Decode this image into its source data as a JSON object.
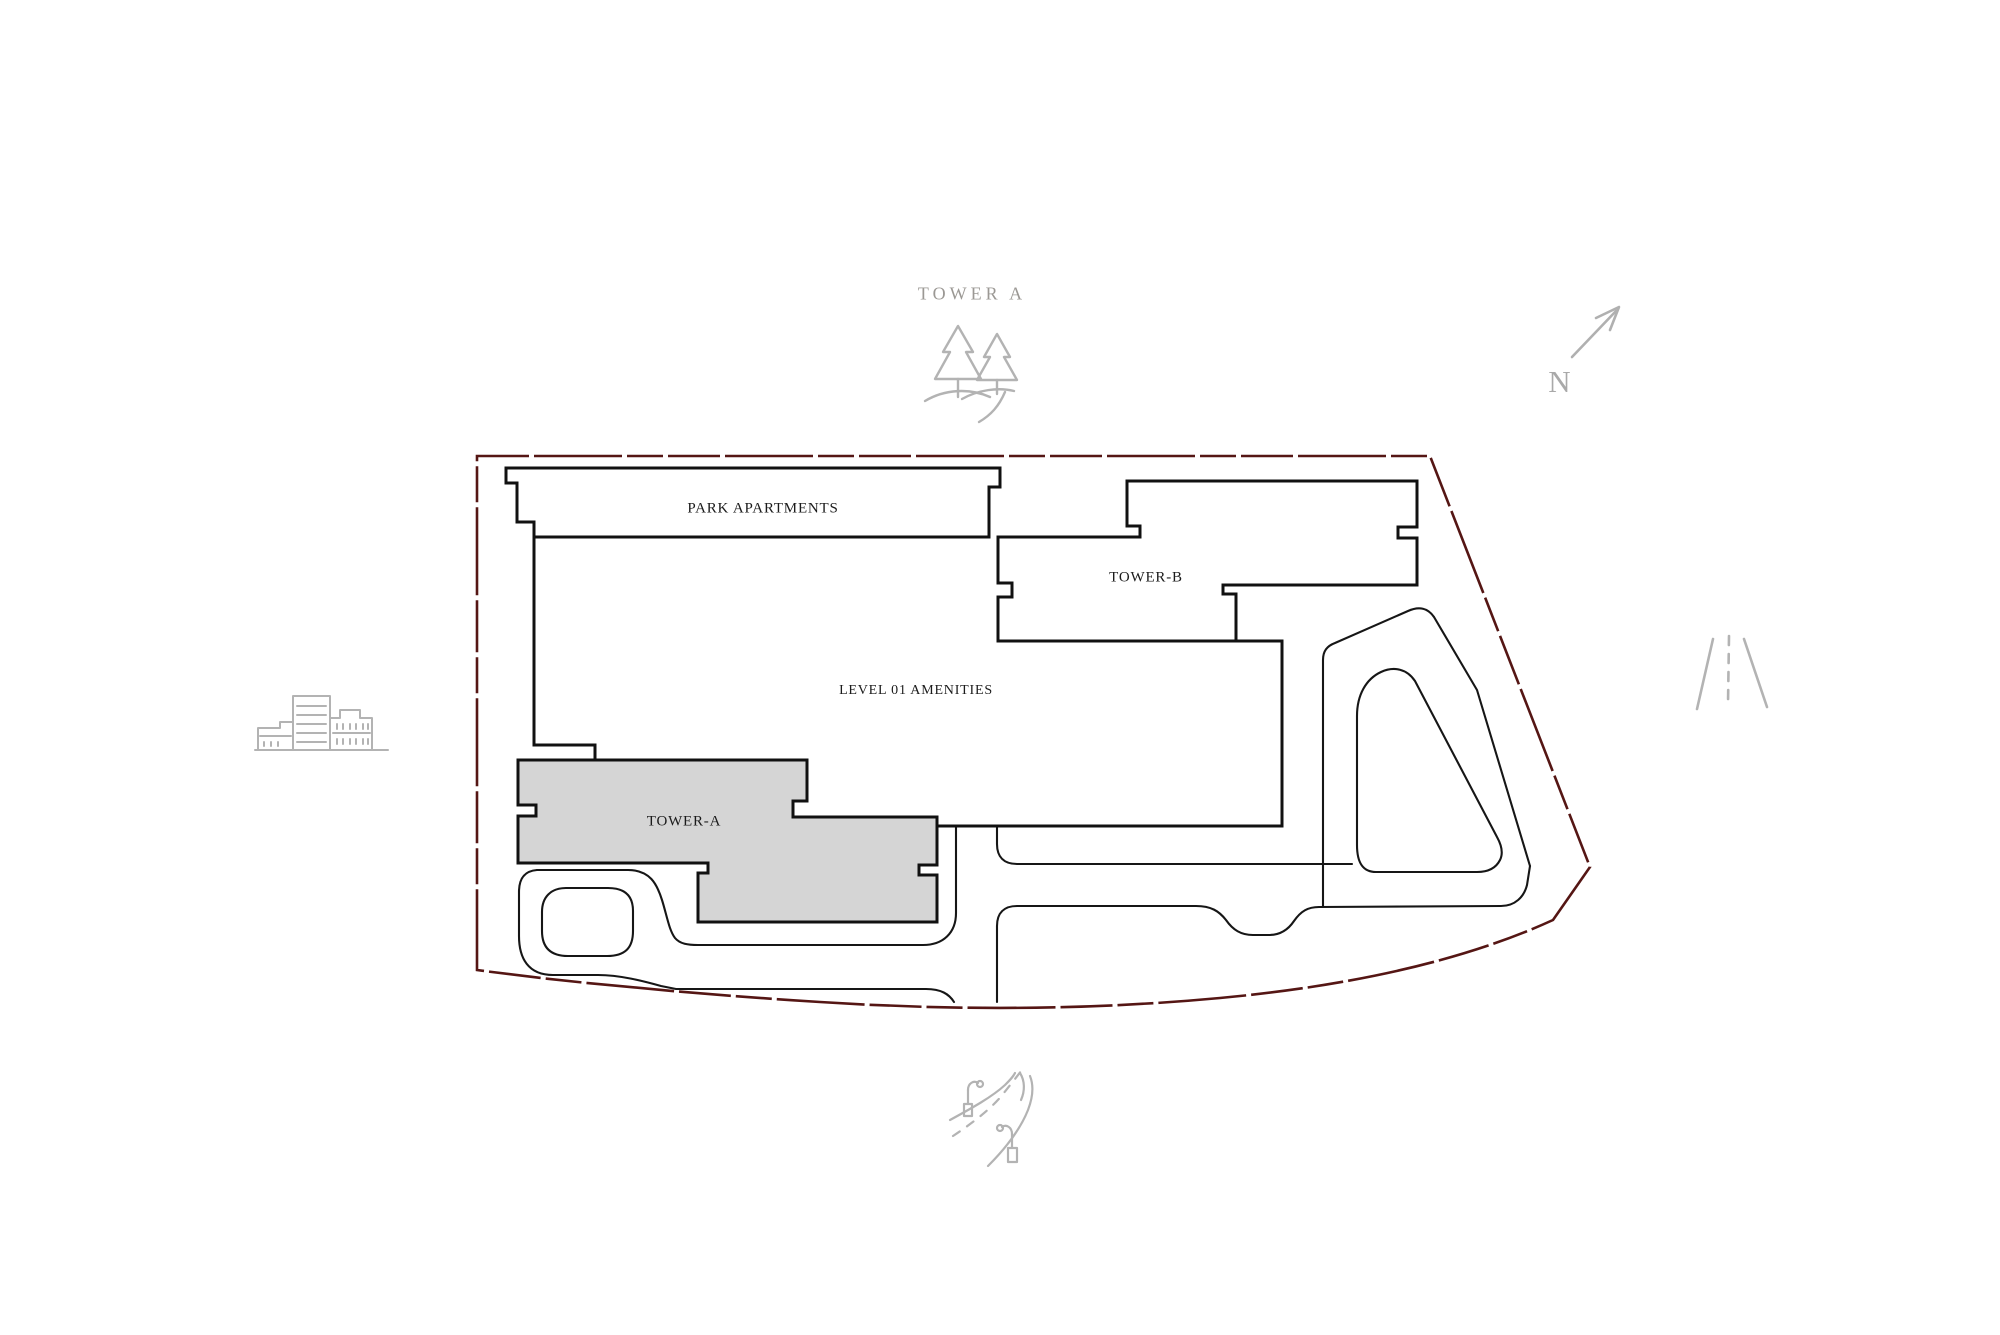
{
  "plan": {
    "header_label": "TOWER A",
    "compass_label": "N",
    "buildings": {
      "park_apartments": "PARK APARTMENTS",
      "tower_b": "TOWER-B",
      "amenities": "LEVEL 01 AMENITIES",
      "tower_a": "TOWER-A"
    },
    "colors": {
      "background": "#ffffff",
      "site_boundary": "#551614",
      "building_outline": "#111111",
      "tower_a_fill": "#d5d5d5",
      "road_line": "#161616",
      "icon_gray": "#b3b3b3",
      "header_gray": "#9b9894",
      "label_text": "#1b1b1b"
    },
    "icons": [
      "trees-icon",
      "north-arrow-icon",
      "city-buildings-icon",
      "road-perspective-icon",
      "road-curve-icon"
    ]
  }
}
